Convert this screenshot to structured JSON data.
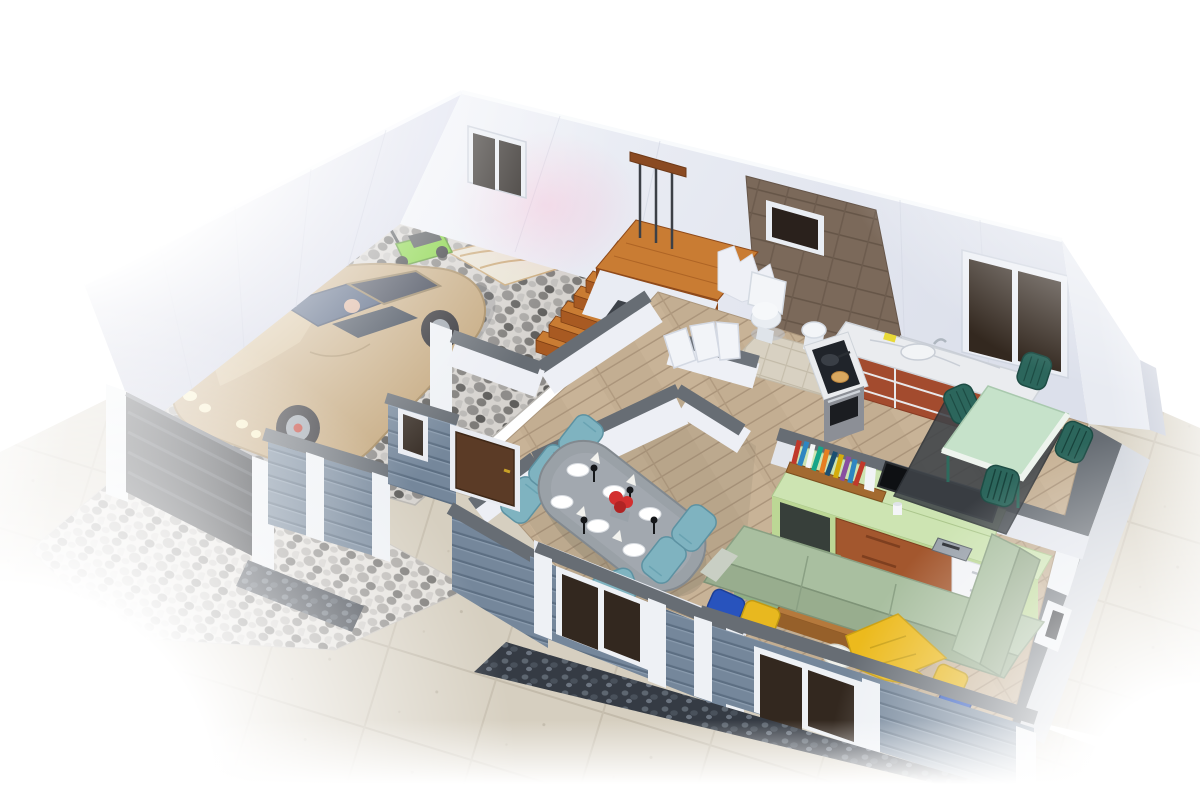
{
  "scene": {
    "type": "3d-floorplan-cutaway-render",
    "view": "isometric-top-down",
    "rooms": [
      {
        "name": "garage",
        "items": [
          "sports-car",
          "lawn-mower",
          "traffic-cone",
          "drop-cloth",
          "pebble-mosaic-floor",
          "driveway-gate"
        ]
      },
      {
        "name": "staircase",
        "items": [
          "wood-steps",
          "landing",
          "railing",
          "under-stair-closet"
        ]
      },
      {
        "name": "bathroom",
        "items": [
          "toilet",
          "pedestal-sink",
          "brown-tile-wall",
          "small-window"
        ]
      },
      {
        "name": "kitchen",
        "items": [
          "l-shaped-counter",
          "marble-top",
          "cooktop",
          "oven",
          "sink",
          "sponge",
          "pan",
          "pancake-plate"
        ]
      },
      {
        "name": "breakfast-nook",
        "items": [
          "mint-square-table",
          "four-dark-teal-chairs",
          "dark-rug",
          "window"
        ]
      },
      {
        "name": "dining-room",
        "items": [
          "oval-gray-table",
          "six-teal-chairs",
          "plates",
          "napkins",
          "black-glasses",
          "red-flower-centerpiece"
        ]
      },
      {
        "name": "living-room",
        "items": [
          "l-shaped-green-sofa",
          "yellow-pillows",
          "blue-pillows",
          "white-pillow",
          "yellow-blanket",
          "wood-coffee-table",
          "magazine",
          "green-daybed",
          "tv-wall-unit",
          "flat-tv",
          "bookshelf",
          "books"
        ]
      },
      {
        "name": "hallway",
        "items": [
          "wood-floor",
          "entry-door",
          "sidelight-window",
          "fan-partition-doors"
        ]
      },
      {
        "name": "exterior",
        "items": [
          "concrete-paving",
          "pebble-mosaic-driveway",
          "gravel-foundation",
          "blue-gray-siding-walls",
          "white-pilasters",
          "windows"
        ]
      }
    ]
  },
  "palette": {
    "wall_white": "#eceff6",
    "wall_white_dim": "#dde1ec",
    "wall_lavender": "#c9cde0",
    "wall_cap": "#676d74",
    "siding": "#75879b",
    "pilaster": "#eef1f5",
    "gate": "#23262b",
    "stair_tread": "#c97c33",
    "stair_riser": "#a85a22",
    "rail_wood": "#8a4a22",
    "floor_wood": "#c3ae92",
    "concrete": "#d6cfc0",
    "gravel": "#353b44",
    "tile_brown": "#7b695a",
    "tile_floor": "#d8d1c2",
    "car_body": "#c3a67b",
    "car_glass": "#2a3142",
    "wheel": "#26262b",
    "rim": "#9ba3ac",
    "headlight": "#f7edc0",
    "mower_green": "#79cf2f",
    "cone_red": "#cf3a2c",
    "porcelain": "#f3f5f8",
    "counter_top": "#eaecef",
    "cabinet_wood": "#a34b2e",
    "stove_black": "#20242a",
    "steel": "#8c8f96",
    "nook_table": "#c6e2ca",
    "nook_chair": "#2c665c",
    "dining_table": "#9aa1a7",
    "dining_chair": "#7fb3c0",
    "tv_black": "#0e1013",
    "unit_green": "#cde4b2",
    "unit_green_dark": "#bcd795",
    "drawer_wood": "#a3572e",
    "drawer_white": "#f2f3f6",
    "shelf_wood": "#a36a30",
    "sofa": "#a9bfa0",
    "sofa_dark": "#98ad8e",
    "pillow_yellow": "#e8b81f",
    "pillow_blue": "#2853bd",
    "blanket": "#ecba1d",
    "ottoman": "#a9c79b",
    "coffee_table": "#b5793c",
    "rug": "#3f4449",
    "flower_red": "#d32f2f",
    "door_brown": "#5b3b26",
    "window_glass": "#33281f",
    "books": [
      "#c0392b",
      "#2e86c1",
      "#f4f6f7",
      "#17a589",
      "#e67e22",
      "#1b4f72",
      "#d4ac0d",
      "#884ea0"
    ]
  }
}
